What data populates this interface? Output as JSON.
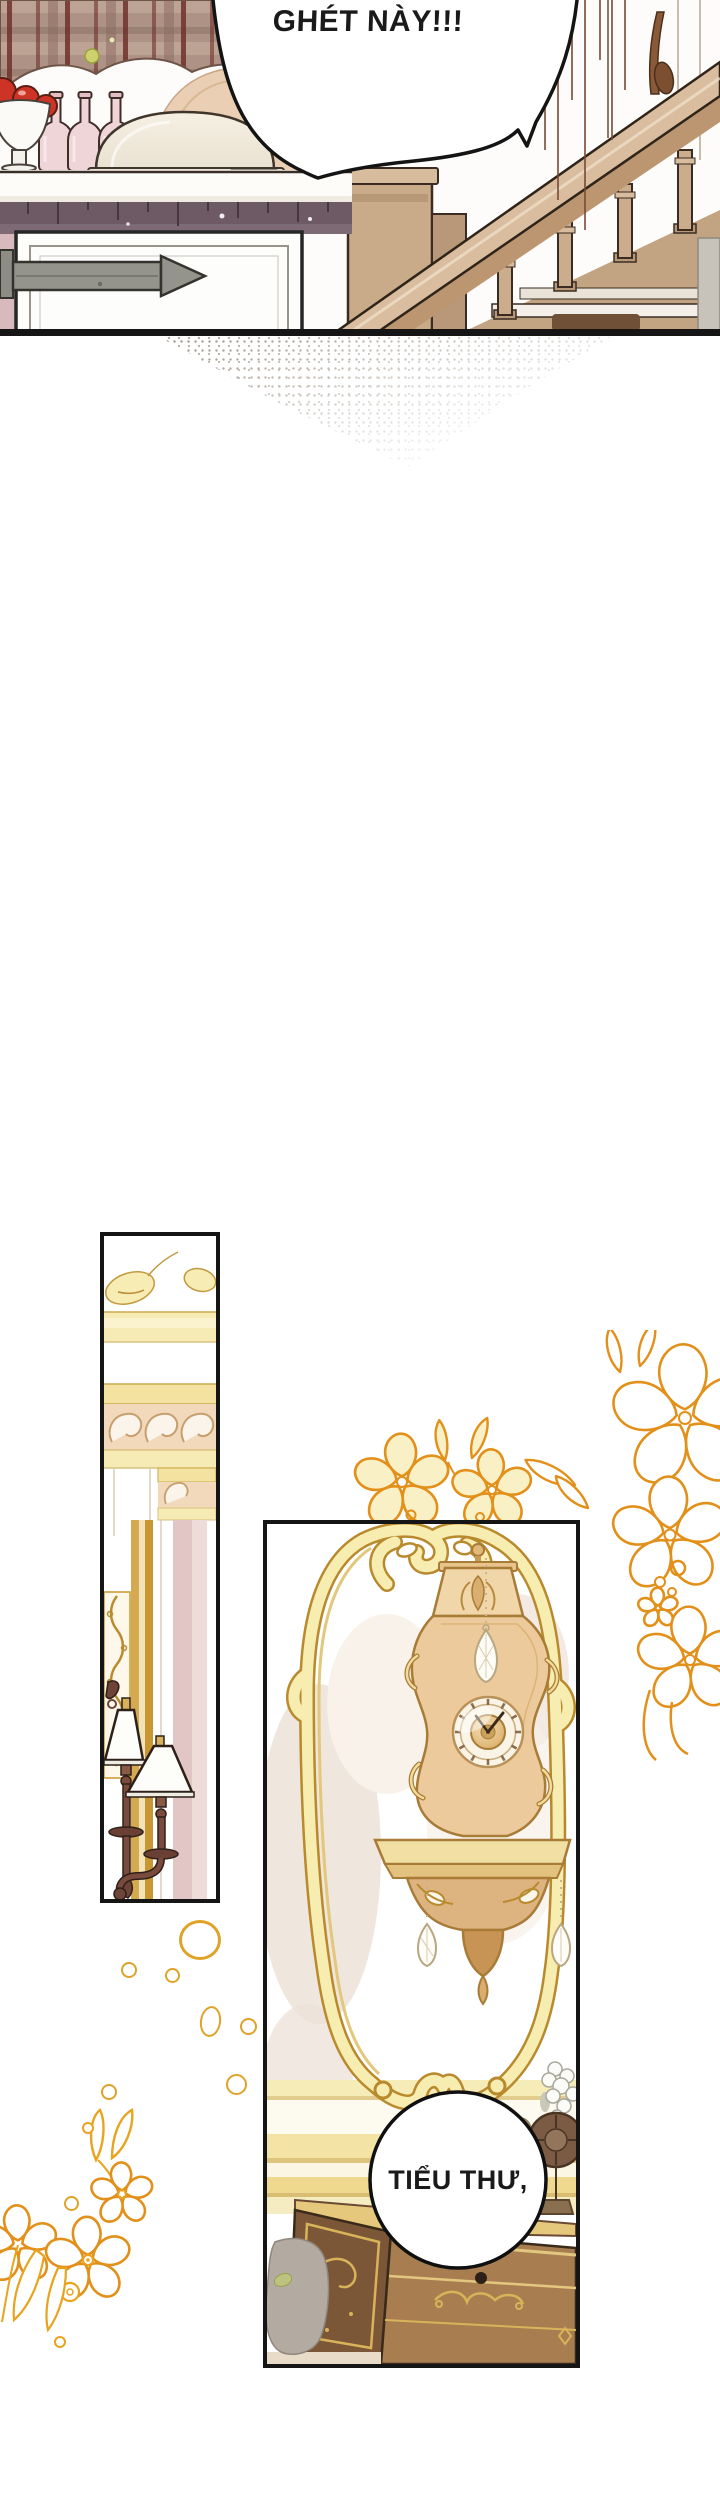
{
  "page": {
    "type": "webtoon comic page",
    "language": "vi",
    "width": 720,
    "height": 2500,
    "background": "#ffffff"
  },
  "panels": {
    "top": {
      "name": "kitchen counter and wooden staircase scene",
      "bubble_text": "GHÉT NÀY!!!"
    },
    "left": {
      "name": "wall detail with rococo cornice and bronze sconce lamps"
    },
    "clock": {
      "name": "ornate golden wall clock above dresser with sewing machine",
      "bubble_text": "TIỂU THƯ,"
    }
  },
  "colors": {
    "page-bg": "#ffffff",
    "ink": "#1a1a1a",
    "panel-border": "#151515",
    "gold-line": "#e2901a",
    "ring-gold": "#dfa32a",
    "frame-gold": "#b9892d",
    "frame-fill": "#f8edb0",
    "cream": "#f6ebb4",
    "plaid": "#ad9285",
    "maroon": "#6f312b",
    "mauve": "#6e5a64",
    "apple": "#ce3426",
    "bottle-pink": "#efd5d8",
    "wood": "#a87e50",
    "wood-dark": "#7b5737",
    "tan": "#cbad8d",
    "bronze": "#7a4a3c",
    "bubble": "#ffffff"
  }
}
